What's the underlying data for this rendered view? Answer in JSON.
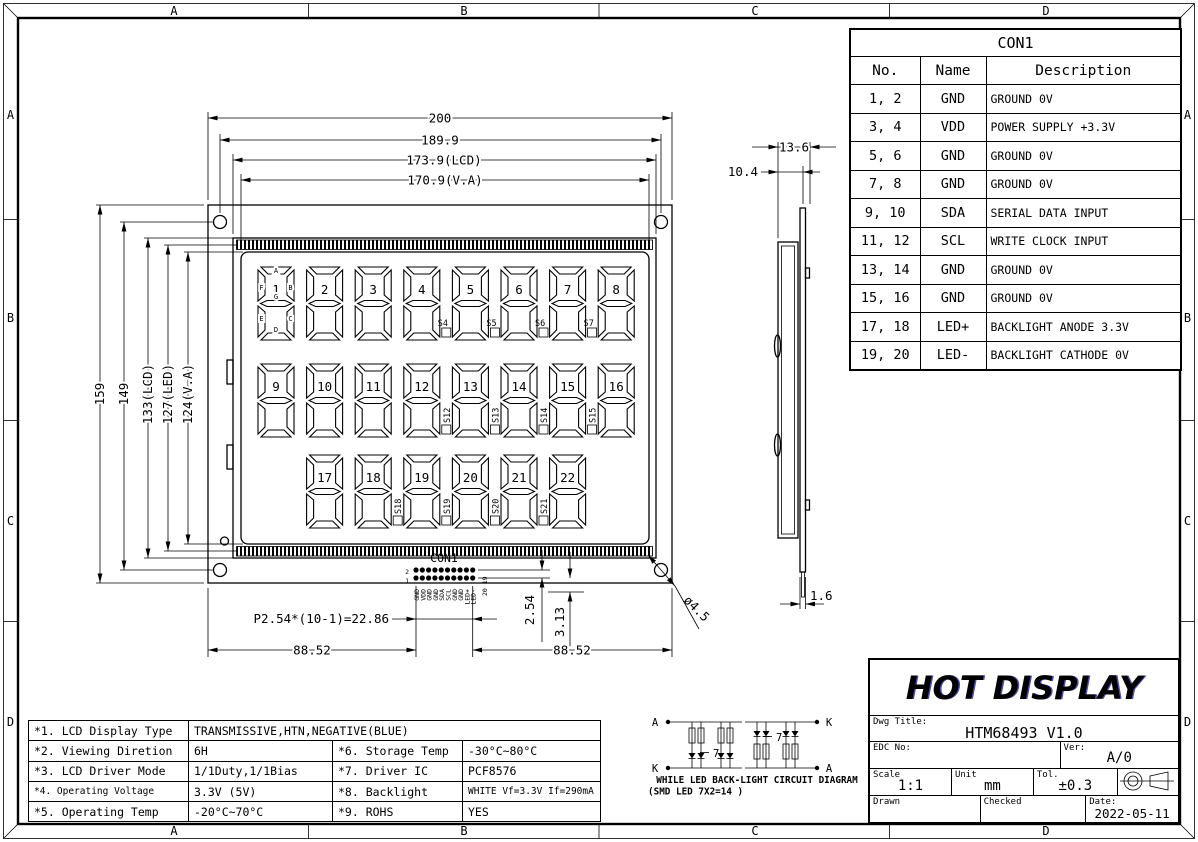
{
  "frame": {
    "zones": [
      "A",
      "B",
      "C",
      "D"
    ]
  },
  "con1": {
    "title": "CON1",
    "headers": [
      "No.",
      "Name",
      "Description"
    ],
    "rows": [
      [
        "1、2",
        "GND",
        "GROUND 0V"
      ],
      [
        "3、4",
        "VDD",
        "POWER SUPPLY +3.3V"
      ],
      [
        "5、6",
        "GND",
        "GROUND 0V"
      ],
      [
        "7、8",
        "GND",
        "GROUND 0V"
      ],
      [
        "9、10",
        "SDA",
        "SERIAL DATA INPUT"
      ],
      [
        "11、12",
        "SCL",
        "WRITE CLOCK INPUT"
      ],
      [
        "13、14",
        "GND",
        "GROUND 0V"
      ],
      [
        "15、16",
        "GND",
        "GROUND 0V"
      ],
      [
        "17、18",
        "LED+",
        "BACKLIGHT ANODE 3.3V"
      ],
      [
        "19、20",
        "LED-",
        "BACKLIGHT CATHODE 0V"
      ]
    ]
  },
  "specs": {
    "full_row": [
      "*1. LCD Display Type",
      "TRANSMISSIVE,HTN,NEGATIVE(BLUE)"
    ],
    "rows": [
      [
        "*2. Viewing Diretion",
        "6H",
        "*6. Storage Temp",
        "-30°C~80°C"
      ],
      [
        "*3. LCD Driver Mode",
        "1/1Duty,1/1Bias",
        "*7. Driver IC",
        "PCF8576"
      ],
      [
        "*4. Operating Voltage",
        "3.3V (5V)",
        "*8. Backlight",
        "WHITE Vf=3.3V If=290mA"
      ],
      [
        "*5. Operating Temp",
        "-20°C~70°C",
        "*9. ROHS",
        "YES"
      ]
    ]
  },
  "title_block": {
    "company": "HOT DISPLAY",
    "dwg_title_label": "Dwg Title:",
    "dwg_title": "HTM68493 V1.0",
    "edc_label": "EDC No:",
    "ver_label": "Ver:",
    "ver": "A/0",
    "scale_label": "Scale",
    "scale": "1:1",
    "unit_label": "Unit",
    "unit": "mm",
    "tol_label": "Tol.",
    "tol": "±0.3",
    "drawn_label": "Drawn",
    "checked_label": "Checked",
    "date_label": "Date:",
    "date": "2022-05-11"
  },
  "front_view": {
    "dims": {
      "w_total": "200",
      "w_holes": "189.9",
      "w_lcd": "173.9(LCD)",
      "w_va": "170.9(V.A)",
      "h_total": "159",
      "h_holes": "149",
      "h_lcd": "133(LCD)",
      "h_led": "127(LED)",
      "h_va": "124(V.A)",
      "pin_pitch": "P2.54*(10-1)=22.86",
      "left": "88.52",
      "right": "88.52",
      "row_pitch": "2.54",
      "row_offset": "3.13",
      "hole_dia": "ø4.5"
    },
    "connector": {
      "label": "CON1",
      "pin_numbers_left": [
        "2",
        "1"
      ],
      "pin_numbers_right": [
        "20",
        "19"
      ],
      "pin_names": [
        "GND",
        "VDD",
        "GND",
        "GND",
        "SDA",
        "SCL",
        "GND",
        "GND",
        "LED+",
        "LED-"
      ]
    },
    "display": {
      "segment_letters": [
        "A",
        "B",
        "C",
        "D",
        "E",
        "F",
        "G"
      ],
      "rows": [
        {
          "digits": [
            "1",
            "2",
            "3",
            "4",
            "5",
            "6",
            "7",
            "8"
          ],
          "markers": [
            {
              "after": 3,
              "label": "S4"
            },
            {
              "after": 4,
              "label": "S5"
            },
            {
              "after": 5,
              "label": "S6"
            },
            {
              "after": 6,
              "label": "S7"
            }
          ],
          "marker_label_orientation": "horizontal"
        },
        {
          "digits": [
            "9",
            "10",
            "11",
            "12",
            "13",
            "14",
            "15",
            "16"
          ],
          "markers": [
            {
              "after": 3,
              "label": "S12"
            },
            {
              "after": 4,
              "label": "S13"
            },
            {
              "after": 5,
              "label": "S14"
            },
            {
              "after": 6,
              "label": "S15"
            }
          ],
          "marker_label_orientation": "vertical"
        },
        {
          "digits": [
            "17",
            "18",
            "19",
            "20",
            "21",
            "22"
          ],
          "markers": [
            {
              "after": 1,
              "label": "S18"
            },
            {
              "after": 2,
              "label": "S19"
            },
            {
              "after": 3,
              "label": "S20"
            },
            {
              "after": 4,
              "label": "S21"
            }
          ],
          "marker_label_orientation": "vertical"
        }
      ]
    }
  },
  "side_view": {
    "dims": {
      "total_thickness": "13.6",
      "lcd_thickness": "10.4",
      "pcb_thickness": "1.6"
    }
  },
  "backlight_circuit": {
    "caption_line1": "WHILE LED BACK-LIGHT CIRCUIT DIAGRAM",
    "caption_line2": "(SMD LED 7X2=14 )",
    "left": {
      "top": "A",
      "bottom": "K",
      "count": "7"
    },
    "right": {
      "top": "K",
      "bottom": "A",
      "count": "7"
    }
  }
}
